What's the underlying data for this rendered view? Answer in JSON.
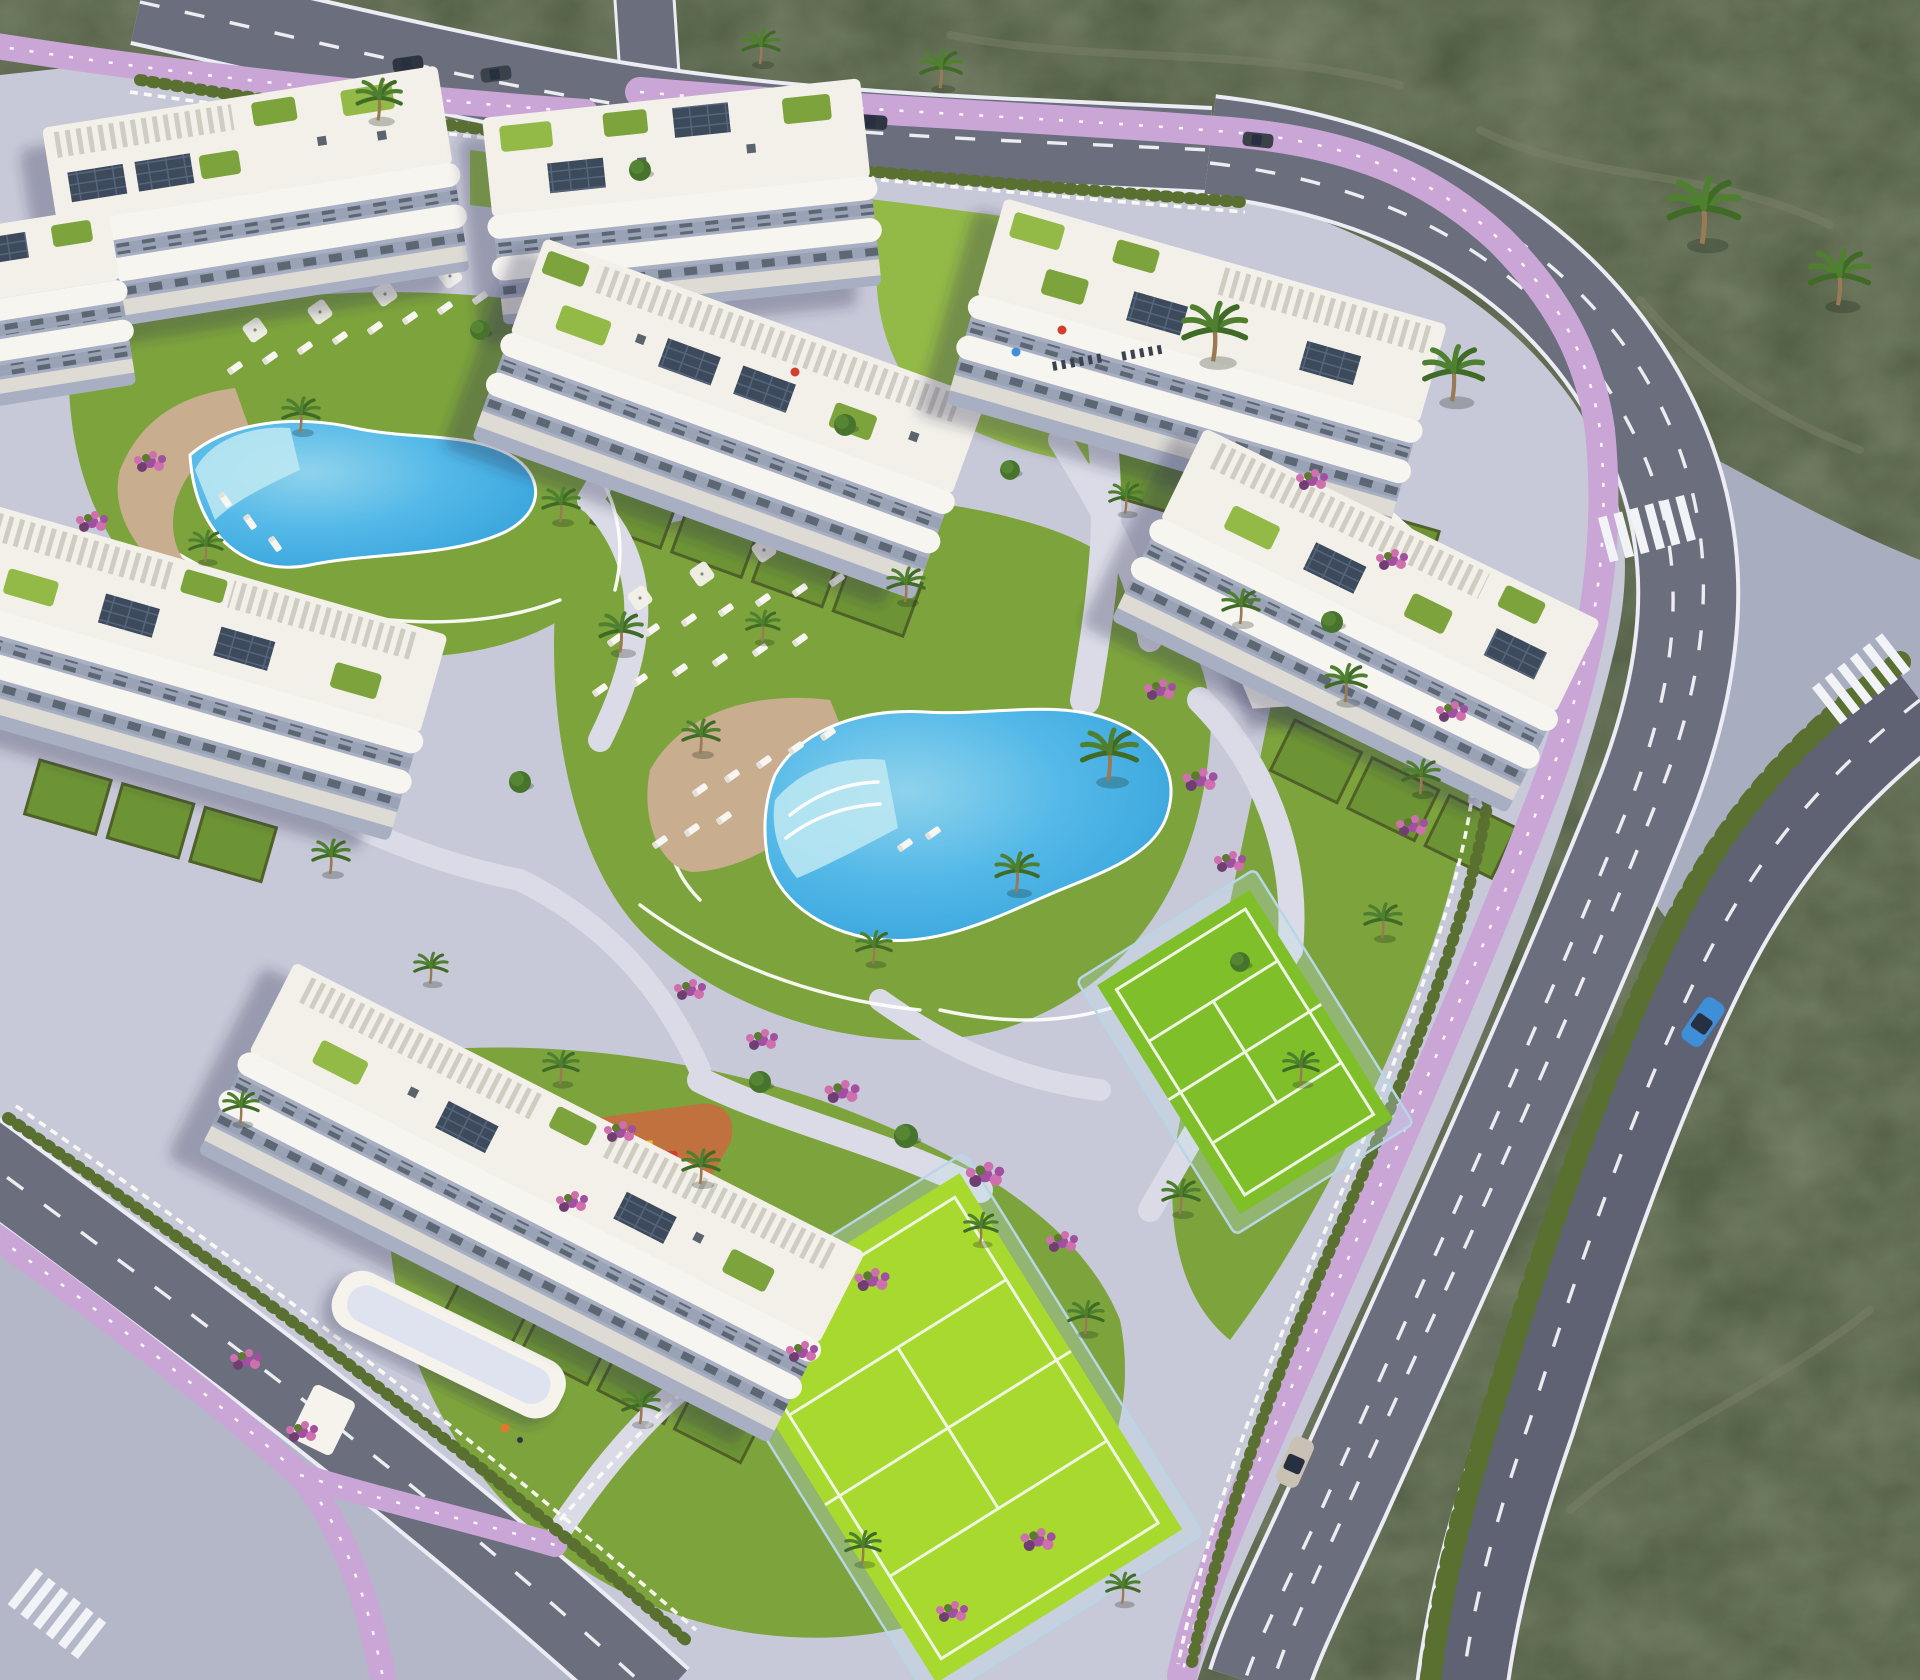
{
  "meta": {
    "title": "Aerial rendering of a gated residential resort complex",
    "description": "Bird's-eye 3D visualization: eight white apartment blocks with tiered balconies, roof terraces, pergolas and solar panels set in landscaped gardens with two lagoon pools, sun loungers, two padel courts, a children's playground, palm trees and flower beds; perimeter roads with lilac cycle lanes, crosswalks and two cars, surrounded by dark scrubland."
  },
  "colors": {
    "scrub": "#4d5840",
    "scrubLight": "#7c8266",
    "pave": "#c7c9d8",
    "island": "#a9adc0",
    "sidewalk": "#b4b7c8",
    "walkway": "#dadbe6",
    "road": "#6b6e7d",
    "roadDark": "#5f6272",
    "line": "#f2f3f7",
    "curb": "#ecedf4",
    "bike": "#c9a6d6",
    "grass": "#7da43c",
    "grassLight": "#93b947",
    "grassDark": "#6d9434",
    "hedge": "#4f6128",
    "cypress": "#5a7030",
    "canopy": "#47742c",
    "frond": "#4f8030",
    "trunk": "#9a7a55",
    "poolDeep": "#2f9ed8",
    "poolShallow": "#bfe9f2",
    "deck": "#c8ad8e",
    "lounger": "#f7f6f2",
    "court": "#7fbf2a",
    "courtBright": "#a8d92f",
    "courtLine": "#eef7df",
    "glassWall": "#b9d6e6",
    "pgOrange": "#c0713d",
    "pgPurple": "#7a5fc8",
    "equipRed": "#d23f2f",
    "equipYellow": "#e8c02c",
    "building": "#f5f3ec",
    "bodyGap": "#a9afc2",
    "windowDark": "#5d6773",
    "roofTone": "#f2f0e9",
    "pergola": "#cfccc2",
    "solar": "#3d4a5c",
    "flower1": "#a14fa1",
    "flower2": "#d06fae",
    "flower3": "#6f3f72",
    "carBlue": "#3e8ed8",
    "carSilver": "#c9c2b4",
    "carDark": "#2e3440",
    "shadow": "rgba(40,45,80,0.30)"
  },
  "scene": {
    "environment": "dry dark-green scrubland surrounding a landscaped resort parcel",
    "buildings": {
      "count": 8,
      "floors": "3-4",
      "features": [
        "white wraparound balconies",
        "roof terraces with planting",
        "pergolas",
        "rooftop solar panels",
        "private ground-floor garden plots"
      ]
    },
    "amenities": {
      "pools": [
        {
          "name": "north pool",
          "loungers": 16,
          "umbrellas": 4,
          "deck": "sand-colored"
        },
        {
          "name": "central lagoon pool",
          "loungers": 26,
          "umbrellas": 4,
          "beach_entry": true,
          "deck": "sand-colored"
        }
      ],
      "padel_courts": 2,
      "playground": {
        "surface_colors": [
          "orange",
          "purple"
        ],
        "equipment": [
          "slide",
          "swing",
          "spring riders",
          "picnic table"
        ]
      },
      "solar_clubhouse": 1,
      "entrance_gate_canopy": 1
    },
    "roads": {
      "cycle_lane_color_name": "lilac",
      "crosswalks": 3,
      "vehicles_moving": [
        {
          "type": "car",
          "color": "blue"
        },
        {
          "type": "car",
          "color": "silver"
        }
      ],
      "vehicles_parked": 4
    },
    "vegetation": {
      "palm_trees": 34,
      "round_trees": 9,
      "hedges": true,
      "flower_beds": 22
    },
    "people": 4
  }
}
